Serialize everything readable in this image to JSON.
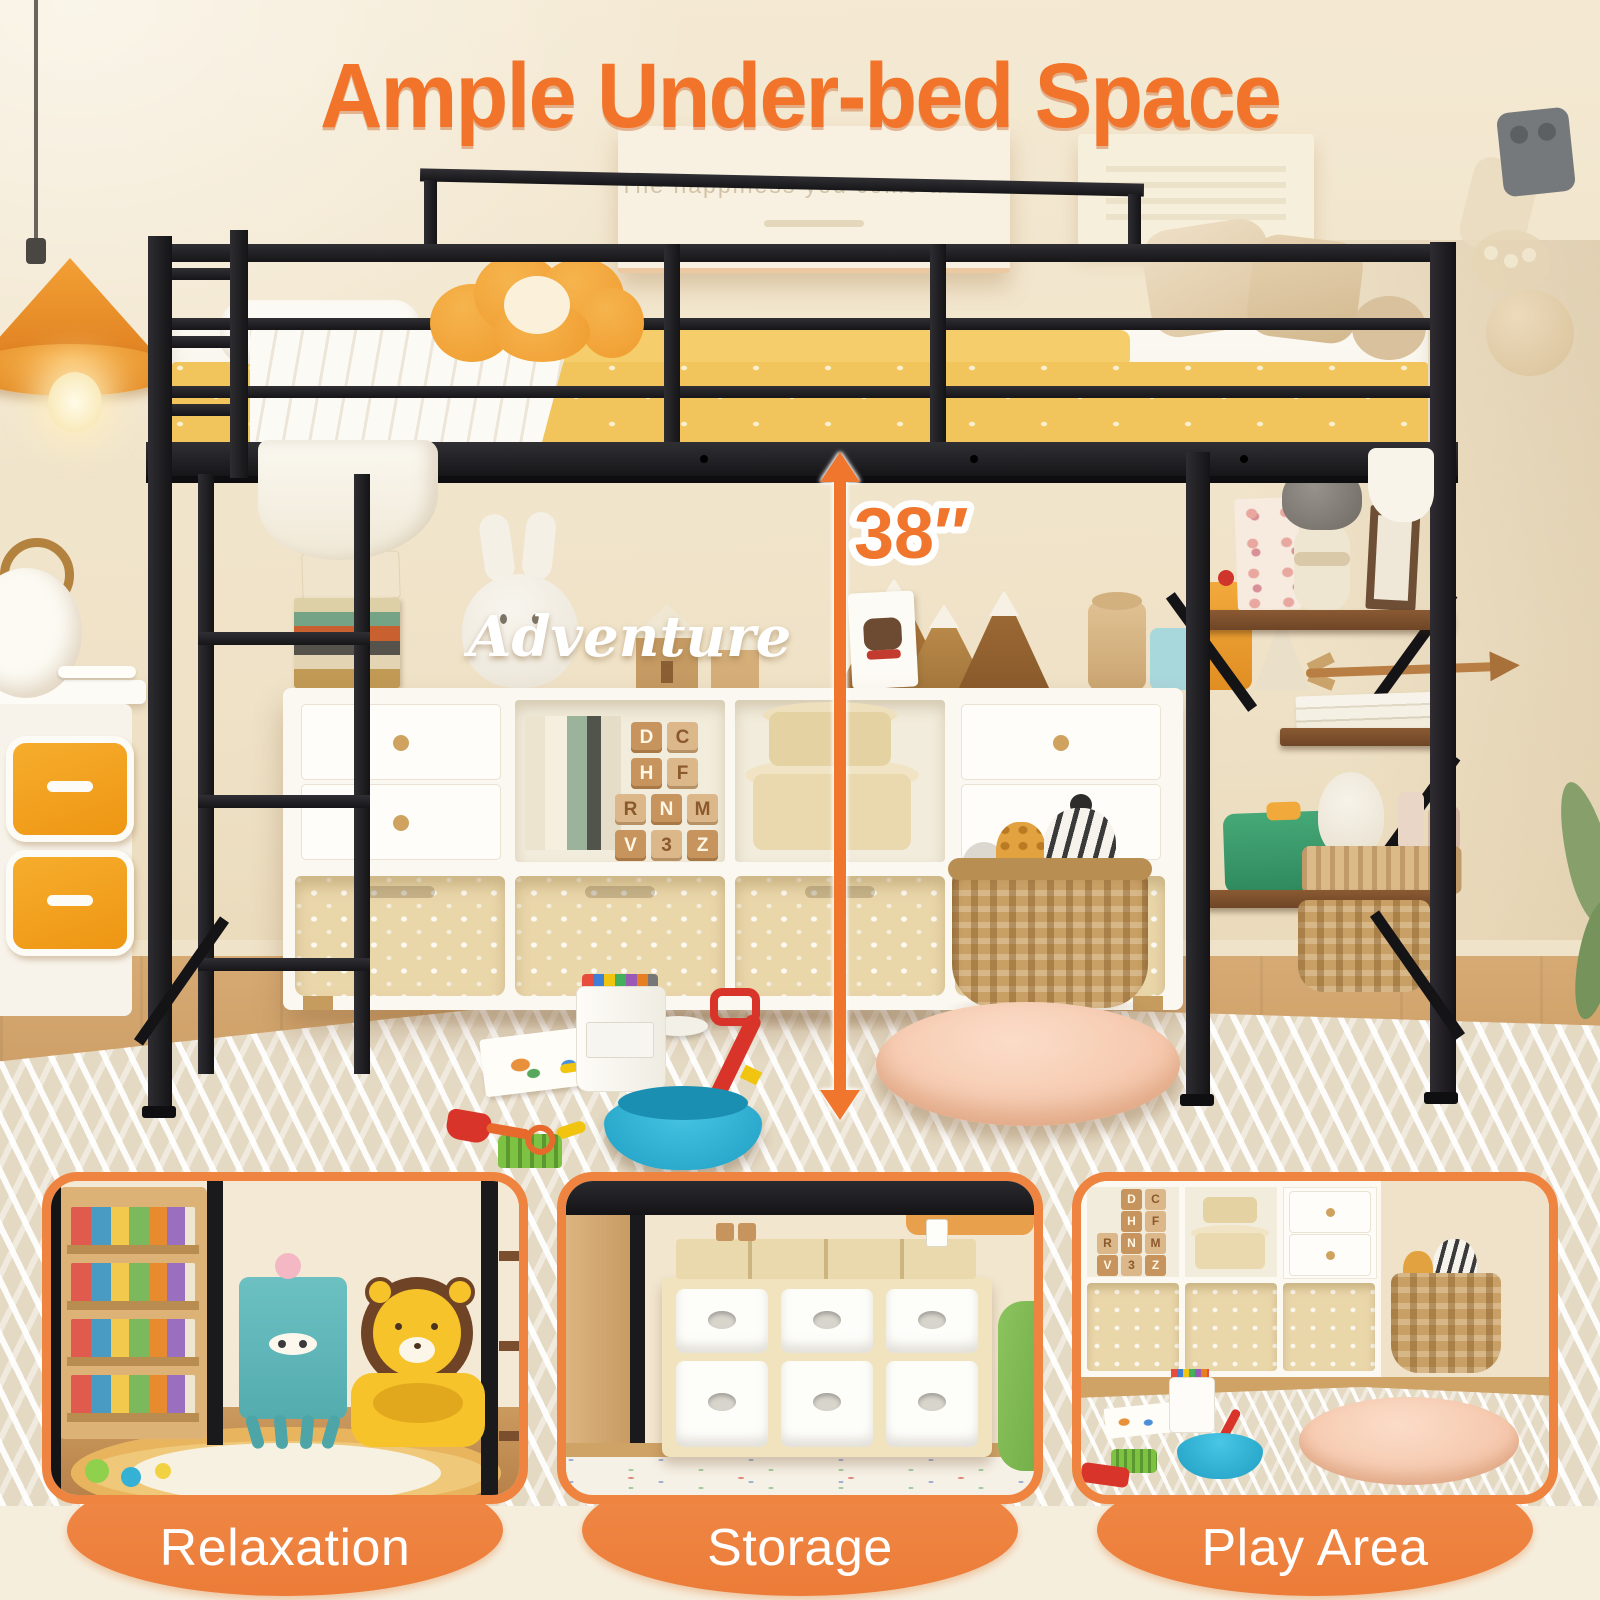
{
  "title": "Ample Under-bed Space",
  "wall_art": {
    "caption": "The happiness you come across"
  },
  "scene": {
    "adventure_sign": "Adventure",
    "measurement_label": "38″",
    "letter_blocks": [
      "D",
      "C",
      "H",
      "F",
      "R",
      "N",
      "M",
      "V",
      "3",
      "Z"
    ]
  },
  "panels": [
    {
      "id": "relaxation",
      "label": "Relaxation"
    },
    {
      "id": "storage",
      "label": "Storage"
    },
    {
      "id": "play-area",
      "label": "Play Area"
    }
  ],
  "colors": {
    "accent_orange": "#f2732a",
    "badge_orange": "#ee7f3c",
    "frame_black": "#1a191b",
    "bedding_yellow": "#f2c55c",
    "background_cream": "#f6eedd",
    "wall_beige": "#f1e5cc",
    "floor_wood": "#c18a4b",
    "cushion_pink": "#f7cdb4",
    "bin_beige": "#e9d6a9",
    "bowl_blue": "#2fb6d9",
    "lion_yellow": "#f6c32a",
    "cabinet_teal": "#62c0c2",
    "lamp_orange": "#ef9c2f"
  }
}
